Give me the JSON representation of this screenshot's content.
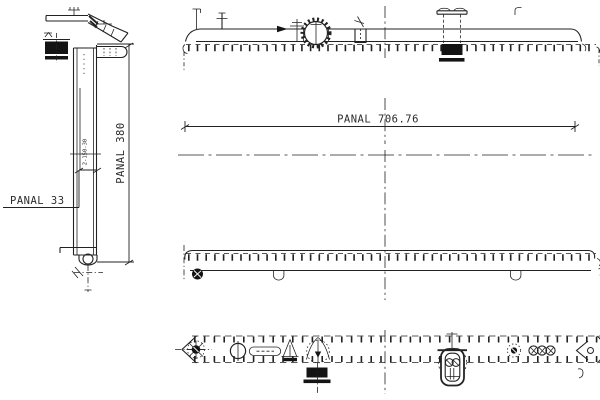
{
  "drawing": {
    "kind": "radiator-engineering-drawing",
    "colors": {
      "background": "#ffffff",
      "line": "#222222"
    },
    "labels": {
      "panel_width": "PANAL 706.76",
      "panel_depth": "PANAL 33",
      "panel_height": "PANAL 380",
      "side_note": "2-150-30"
    }
  }
}
